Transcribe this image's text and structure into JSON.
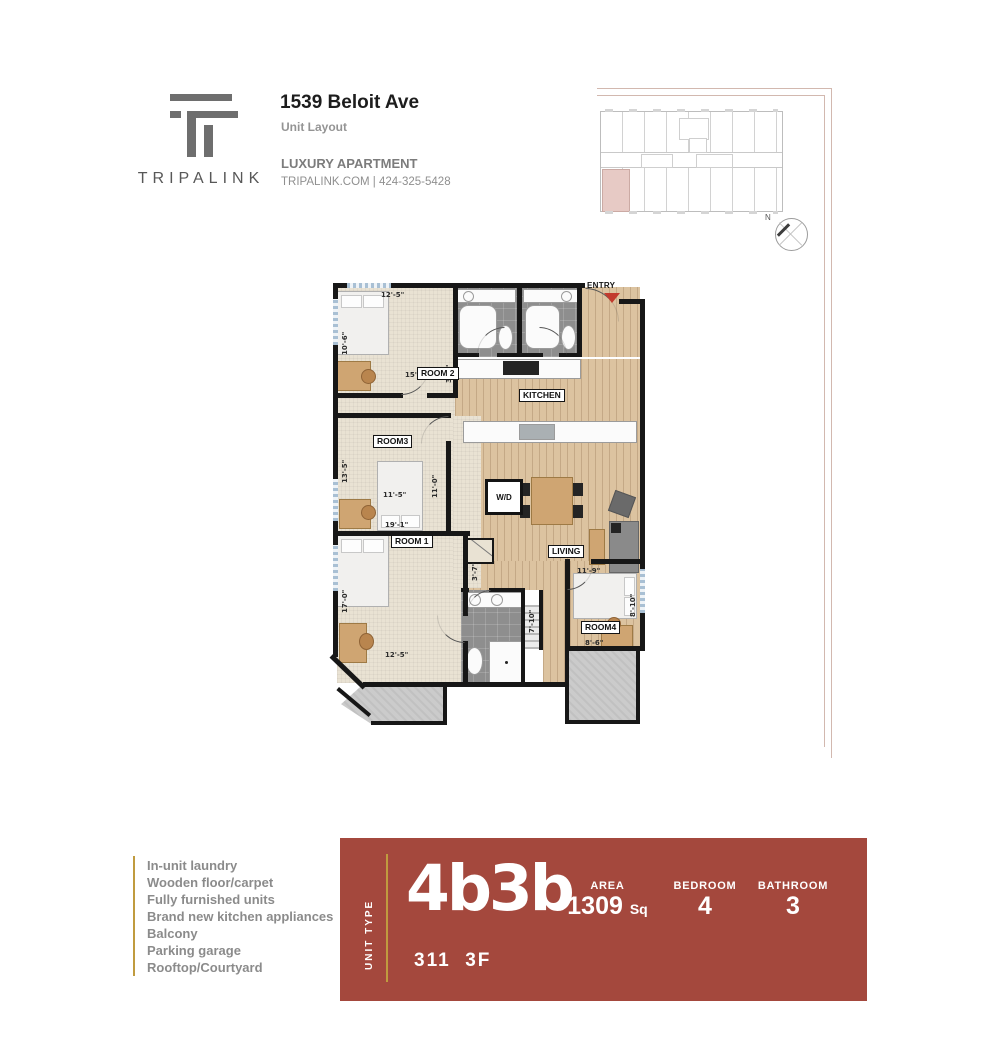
{
  "header": {
    "brand": "TRIPALINK",
    "address": "1539 Beloit Ave",
    "subtitle": "Unit Layout",
    "tagline": "LUXURY APARTMENT",
    "contact": "TRIPALINK.COM | 424-325-5428"
  },
  "keyplan": {
    "compass_n": "N"
  },
  "floorplan": {
    "entry_label": "ENTRY",
    "labels": {
      "room2": "ROOM 2",
      "room3": "ROOM3",
      "room1": "ROOM 1",
      "room4": "ROOM4",
      "kitchen": "KITCHEN",
      "living": "LIVING",
      "wd": "W/D"
    },
    "dims": {
      "room2_top": "12'-5\"",
      "room2_left": "10'-6\"",
      "room2_w": "15'",
      "bath_door": "3'-4\"",
      "room3_left": "13'-5\"",
      "room3_right": "11'-0\"",
      "room3_bed": "11'-5\"",
      "room1_top": "19'-1\"",
      "closet": "3'-7\"",
      "room1_left": "17'-0\"",
      "room1_bottom": "12'-5\"",
      "hall": "7'-10\"",
      "room4_top": "11'-9\"",
      "room4_right": "8'-10\"",
      "room4_bottom": "8'-6\""
    }
  },
  "features": {
    "items": [
      "In-unit laundry",
      "Wooden floor/carpet",
      "Fully furnished units",
      "Brand new kitchen appliances",
      "Balcony",
      "Parking garage",
      "Rooftop/Courtyard"
    ]
  },
  "banner": {
    "unit_type_label": "UNIT TYPE",
    "unit_type": "4b3b",
    "area_label": "AREA",
    "area_value": "1309",
    "area_unit": "Sq",
    "bedroom_label": "BEDROOM",
    "bedroom_value": "4",
    "bathroom_label": "BATHROOM",
    "bathroom_value": "3",
    "unit_floor": "311  3F"
  },
  "colors": {
    "banner_red": "#a4483d",
    "accent_gold": "#c09b3f",
    "entry_arrow_red": "#c23b2e",
    "keyplan_highlight": "#e7cac5"
  }
}
